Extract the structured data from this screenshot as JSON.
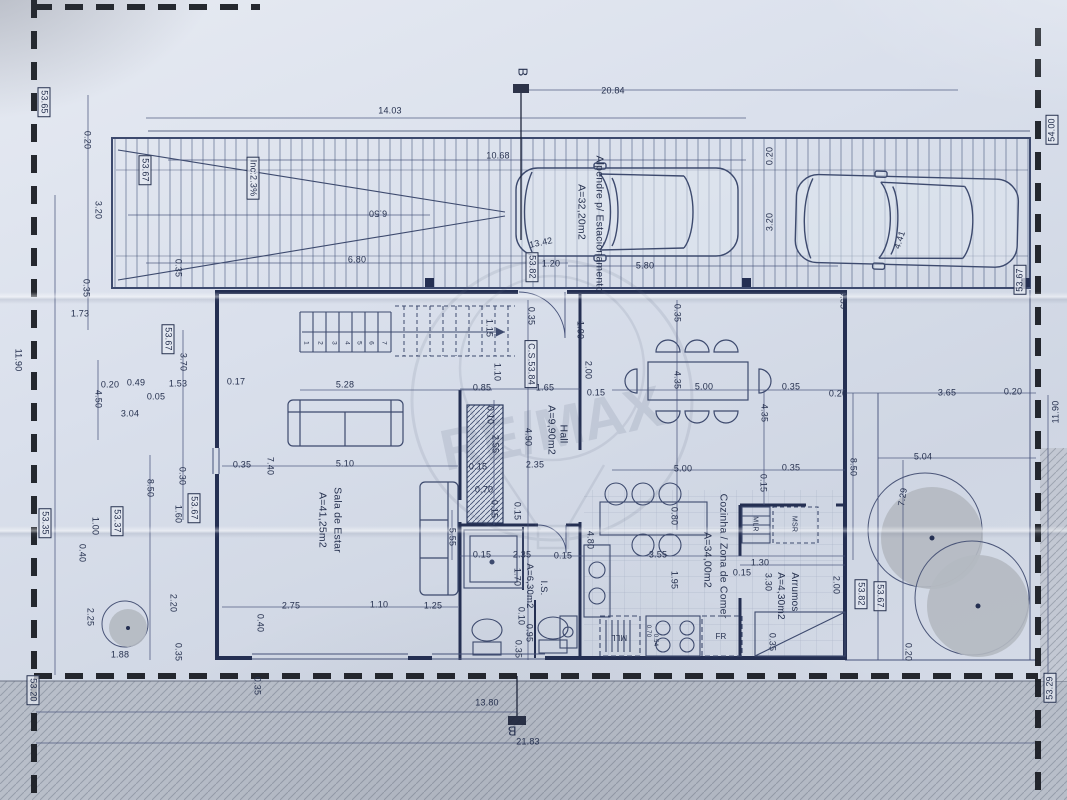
{
  "watermark": {
    "text": "RE/MAX"
  },
  "colors": {
    "paper": "#d7dde8",
    "ink": "#2c3a5e",
    "walls": "#242f52",
    "boundary": "#15181e",
    "road": "#b8bec9",
    "tree": "#b4b9c1"
  },
  "section_markers": {
    "top": "B",
    "bottom": "B"
  },
  "rooms": [
    {
      "name": "Sala de Estar",
      "area": "A=41,25m2"
    },
    {
      "name": "Hall",
      "area": "A=9,90m2"
    },
    {
      "name": "Cozinha / Zona de Comer",
      "area": "A=34,00m2"
    },
    {
      "name": "I.S.",
      "area": "A=6,30m2"
    },
    {
      "name": "Arrumos",
      "area": "A=4,30m2"
    },
    {
      "name": "Alpendre p/ Estacionamento",
      "area": "A=32,20m2"
    }
  ],
  "plan": {
    "labels": [
      {
        "n": "section-marker-top",
        "t": "B",
        "x": 523,
        "y": 72,
        "r": 90,
        "fs": 13
      },
      {
        "t": "20.84",
        "x": 613,
        "y": 91
      },
      {
        "t": "14.03",
        "x": 390,
        "y": 111
      },
      {
        "t": "10.68",
        "x": 498,
        "y": 156
      },
      {
        "n": "ramp-slope-label",
        "t": "Inc:2.3%",
        "x": 253,
        "y": 178,
        "r": 90,
        "box": 1
      },
      {
        "n": "elevation-label",
        "t": "53.67",
        "x": 145,
        "y": 170,
        "r": 90,
        "box": 1
      },
      {
        "n": "elevation-label",
        "t": "53.65",
        "x": 44,
        "y": 102,
        "r": 90,
        "box": 1
      },
      {
        "t": "0.20",
        "x": 87,
        "y": 140,
        "r": 90
      },
      {
        "t": "3.20",
        "x": 98,
        "y": 210,
        "r": 90
      },
      {
        "t": "0.35",
        "x": 86,
        "y": 288,
        "r": 90
      },
      {
        "t": "1.73",
        "x": 80,
        "y": 314
      },
      {
        "t": "6.50",
        "x": 378,
        "y": 213,
        "r": 180
      },
      {
        "t": "6.80",
        "x": 357,
        "y": 260
      },
      {
        "t": "0.35",
        "x": 178,
        "y": 268,
        "r": 90
      },
      {
        "t": "13.42",
        "x": 541,
        "y": 243,
        "r": -12
      },
      {
        "n": "elevation-label",
        "t": "53.82",
        "x": 532,
        "y": 267,
        "r": 90,
        "box": 1
      },
      {
        "t": "1.20",
        "x": 551,
        "y": 264
      },
      {
        "t": "5.80",
        "x": 645,
        "y": 266
      },
      {
        "t": "0.20",
        "x": 770,
        "y": 156,
        "r": -90
      },
      {
        "t": "3.20",
        "x": 770,
        "y": 222,
        "r": -90
      },
      {
        "n": "room-label-alpendre",
        "t": "Alpendre p/ Estacionamento",
        "x": 599,
        "y": 224,
        "r": 90,
        "fs": 10.5
      },
      {
        "n": "room-area-alpendre",
        "t": "A=32,20m2",
        "x": 581,
        "y": 212,
        "r": 90,
        "fs": 10.5
      },
      {
        "t": "4.41",
        "x": 900,
        "y": 240,
        "r": -72
      },
      {
        "t": "0.35",
        "x": 843,
        "y": 300,
        "r": 90
      },
      {
        "n": "elevation-label",
        "t": "53.67",
        "x": 1020,
        "y": 280,
        "r": -90,
        "box": 1
      },
      {
        "n": "elevation-label",
        "t": "54.00",
        "x": 1052,
        "y": 130,
        "r": -90,
        "box": 1
      },
      {
        "t": "0.20",
        "x": 838,
        "y": 394
      },
      {
        "t": "3.65",
        "x": 947,
        "y": 393
      },
      {
        "t": "0.20",
        "x": 1013,
        "y": 392
      },
      {
        "t": "11.90",
        "x": 1056,
        "y": 412,
        "r": -90
      },
      {
        "t": "5.04",
        "x": 923,
        "y": 457
      },
      {
        "t": "7.29",
        "x": 903,
        "y": 497,
        "r": -80
      },
      {
        "t": "8.50",
        "x": 853,
        "y": 467,
        "r": 90
      },
      {
        "n": "elevation-label",
        "t": "53.82",
        "x": 861,
        "y": 594,
        "r": 90,
        "box": 1
      },
      {
        "n": "elevation-label",
        "t": "53.67",
        "x": 880,
        "y": 596,
        "r": 90,
        "box": 1
      },
      {
        "t": "0.20",
        "x": 908,
        "y": 652,
        "r": 90
      },
      {
        "t": "2.00",
        "x": 836,
        "y": 585,
        "r": 90
      },
      {
        "n": "elevation-label",
        "t": "53.29",
        "x": 1050,
        "y": 688,
        "r": -90,
        "box": 1
      },
      {
        "t": "11.90",
        "x": 18,
        "y": 360,
        "r": 90
      },
      {
        "n": "elevation-label",
        "t": "53.35",
        "x": 45,
        "y": 523,
        "r": 90,
        "box": 1
      },
      {
        "n": "elevation-label",
        "t": "53.37",
        "x": 117,
        "y": 521,
        "r": 90,
        "box": 1
      },
      {
        "t": "1.00",
        "x": 95,
        "y": 526,
        "r": 90
      },
      {
        "n": "elevation-label",
        "t": "53.20",
        "x": 33,
        "y": 690,
        "r": 90,
        "box": 1
      },
      {
        "t": "0.40",
        "x": 82,
        "y": 553,
        "r": 90
      },
      {
        "t": "2.25",
        "x": 90,
        "y": 617,
        "r": 90
      },
      {
        "t": "1.88",
        "x": 120,
        "y": 655
      },
      {
        "t": "2.20",
        "x": 173,
        "y": 603,
        "r": 90
      },
      {
        "t": "0.35",
        "x": 178,
        "y": 652,
        "r": 90
      },
      {
        "t": "8.50",
        "x": 150,
        "y": 488,
        "r": 90
      },
      {
        "t": "0.30",
        "x": 182,
        "y": 476,
        "r": 90
      },
      {
        "t": "1.60",
        "x": 178,
        "y": 514,
        "r": 90
      },
      {
        "n": "elevation-label",
        "t": "53.67",
        "x": 194,
        "y": 508,
        "r": 90,
        "box": 1
      },
      {
        "t": "4.50",
        "x": 98,
        "y": 399,
        "r": 90
      },
      {
        "t": "0.20",
        "x": 110,
        "y": 385
      },
      {
        "t": "0.49",
        "x": 136,
        "y": 383
      },
      {
        "t": "0.05",
        "x": 156,
        "y": 397
      },
      {
        "t": "3.04",
        "x": 130,
        "y": 414
      },
      {
        "t": "1.53",
        "x": 178,
        "y": 384
      },
      {
        "t": "3.70",
        "x": 183,
        "y": 362,
        "r": 90
      },
      {
        "n": "elevation-label",
        "t": "53.67",
        "x": 168,
        "y": 339,
        "r": 90,
        "box": 1
      },
      {
        "t": "0.17",
        "x": 236,
        "y": 382
      },
      {
        "t": "0.35",
        "x": 242,
        "y": 465
      },
      {
        "t": "7.40",
        "x": 270,
        "y": 466,
        "r": 90
      },
      {
        "t": "5.28",
        "x": 345,
        "y": 385
      },
      {
        "t": "5.10",
        "x": 345,
        "y": 464
      },
      {
        "t": "0.85",
        "x": 482,
        "y": 388
      },
      {
        "t": "1.65",
        "x": 545,
        "y": 388
      },
      {
        "t": "0.15",
        "x": 596,
        "y": 393
      },
      {
        "t": "1.15",
        "x": 489,
        "y": 328,
        "r": 90
      },
      {
        "t": "1.10",
        "x": 497,
        "y": 372,
        "r": 90
      },
      {
        "t": "0.35",
        "x": 531,
        "y": 316,
        "r": 90
      },
      {
        "n": "elevation-label",
        "t": "C.S.53.84",
        "x": 531,
        "y": 364,
        "r": 90,
        "box": 1
      },
      {
        "t": "1.00",
        "x": 580,
        "y": 330,
        "r": 90
      },
      {
        "t": "2.00",
        "x": 588,
        "y": 370,
        "r": 90
      },
      {
        "t": "4.90",
        "x": 528,
        "y": 437,
        "r": 90
      },
      {
        "t": "2.35",
        "x": 535,
        "y": 465
      },
      {
        "t": "0.10",
        "x": 490,
        "y": 415,
        "r": 90
      },
      {
        "t": "2.55",
        "x": 495,
        "y": 444,
        "r": 90
      },
      {
        "t": "0.15",
        "x": 478,
        "y": 467
      },
      {
        "t": "0.70",
        "x": 484,
        "y": 490
      },
      {
        "t": "0.15",
        "x": 494,
        "y": 509,
        "r": 90
      },
      {
        "t": "0.15",
        "x": 517,
        "y": 511,
        "r": 90
      },
      {
        "t": "5.55",
        "x": 452,
        "y": 537,
        "r": 90
      },
      {
        "n": "room-label-sala",
        "t": "Sala de Estar",
        "x": 337,
        "y": 520,
        "r": 90,
        "fs": 10.5
      },
      {
        "n": "room-area-sala",
        "t": "A=41,25m2",
        "x": 322,
        "y": 520,
        "r": 90,
        "fs": 10.5
      },
      {
        "n": "room-label-hall",
        "t": "Hall",
        "x": 563,
        "y": 434,
        "r": 90,
        "fs": 10.5
      },
      {
        "n": "room-area-hall",
        "t": "A=9,90m2",
        "x": 551,
        "y": 430,
        "r": 90,
        "fs": 10.5
      },
      {
        "t": "0.35",
        "x": 677,
        "y": 313,
        "r": 90
      },
      {
        "t": "4.35",
        "x": 677,
        "y": 380,
        "r": 90
      },
      {
        "t": "5.00",
        "x": 704,
        "y": 387
      },
      {
        "t": "0.35",
        "x": 791,
        "y": 387
      },
      {
        "t": "4.35",
        "x": 764,
        "y": 413,
        "r": 90
      },
      {
        "t": "5.00",
        "x": 683,
        "y": 469
      },
      {
        "t": "0.35",
        "x": 791,
        "y": 468
      },
      {
        "t": "0.15",
        "x": 763,
        "y": 483,
        "r": 90
      },
      {
        "t": "0.80",
        "x": 674,
        "y": 516,
        "r": 90
      },
      {
        "n": "room-label-cozinha",
        "t": "Cozinha / Zona de Comer",
        "x": 723,
        "y": 556,
        "r": 90,
        "fs": 10.5
      },
      {
        "n": "room-area-cozinha",
        "t": "A=34,00m2",
        "x": 707,
        "y": 560,
        "r": 90,
        "fs": 10.5
      },
      {
        "t": "4.80",
        "x": 590,
        "y": 540,
        "r": 90
      },
      {
        "t": "3.55",
        "x": 658,
        "y": 555
      },
      {
        "t": "1.95",
        "x": 674,
        "y": 580,
        "r": 90
      },
      {
        "t": "1.30",
        "x": 760,
        "y": 563
      },
      {
        "t": "0.15",
        "x": 742,
        "y": 573
      },
      {
        "t": "3.30",
        "x": 768,
        "y": 582,
        "r": 90
      },
      {
        "n": "room-label-arrumos",
        "t": "Arrumos",
        "x": 794,
        "y": 592,
        "r": 90,
        "fs": 10
      },
      {
        "n": "room-area-arrumos",
        "t": "A=4,30m2",
        "x": 780,
        "y": 596,
        "r": 90,
        "fs": 10
      },
      {
        "n": "closet-label",
        "t": "MLR",
        "x": 755,
        "y": 524,
        "r": 90,
        "fs": 7
      },
      {
        "n": "closet-label",
        "t": "MSR",
        "x": 794,
        "y": 524,
        "r": 90,
        "fs": 7
      },
      {
        "t": "0.35",
        "x": 772,
        "y": 642,
        "r": 90
      },
      {
        "n": "appliance-label-dishwasher",
        "t": "MLL",
        "x": 619,
        "y": 637,
        "r": 180,
        "fs": 8
      },
      {
        "n": "appliance-label-fridge",
        "t": "FR",
        "x": 721,
        "y": 637,
        "fs": 8
      },
      {
        "t": "0.70",
        "x": 648,
        "y": 631,
        "r": 90,
        "fs": 6
      },
      {
        "t": "0.54",
        "x": 655,
        "y": 640,
        "r": 90,
        "fs": 6
      },
      {
        "t": "0.15",
        "x": 482,
        "y": 555
      },
      {
        "t": "2.35",
        "x": 522,
        "y": 555
      },
      {
        "t": "0.15",
        "x": 563,
        "y": 556
      },
      {
        "n": "room-label-is",
        "t": "I.S.",
        "x": 543,
        "y": 588,
        "r": 90,
        "fs": 9.5
      },
      {
        "n": "room-area-is",
        "t": "A=6,30m2",
        "x": 529,
        "y": 586,
        "r": 90,
        "fs": 9.5
      },
      {
        "t": "1.70",
        "x": 517,
        "y": 577,
        "r": 90
      },
      {
        "t": "0.10",
        "x": 521,
        "y": 616,
        "r": 90
      },
      {
        "t": "0.95",
        "x": 529,
        "y": 633,
        "r": 90
      },
      {
        "t": "0.35",
        "x": 518,
        "y": 649,
        "r": 90
      },
      {
        "t": "0.35",
        "x": 257,
        "y": 686,
        "r": 90
      },
      {
        "t": "2.75",
        "x": 291,
        "y": 606
      },
      {
        "t": "1.10",
        "x": 379,
        "y": 605
      },
      {
        "t": "1.25",
        "x": 433,
        "y": 606
      },
      {
        "t": "0.40",
        "x": 260,
        "y": 623,
        "r": 90
      },
      {
        "t": "13.80",
        "x": 487,
        "y": 703
      },
      {
        "n": "section-marker-bottom",
        "t": "B",
        "x": 512,
        "y": 731,
        "r": 180,
        "fs": 13
      },
      {
        "t": "21.83",
        "x": 528,
        "y": 742
      },
      {
        "n": "stair-step-number",
        "t": "1",
        "x": 305,
        "y": 343,
        "r": 90,
        "fs": 6.5
      },
      {
        "n": "stair-step-number",
        "t": "2",
        "x": 319,
        "y": 343,
        "r": 90,
        "fs": 6.5
      },
      {
        "n": "stair-step-number",
        "t": "3",
        "x": 333,
        "y": 343,
        "r": 90,
        "fs": 6.5
      },
      {
        "n": "stair-step-number",
        "t": "4",
        "x": 346,
        "y": 343,
        "r": 90,
        "fs": 6.5
      },
      {
        "n": "stair-step-number",
        "t": "5",
        "x": 358,
        "y": 343,
        "r": 90,
        "fs": 6.5
      },
      {
        "n": "stair-step-number",
        "t": "6",
        "x": 370,
        "y": 343,
        "r": 90,
        "fs": 6.5
      },
      {
        "n": "stair-step-number",
        "t": "7",
        "x": 383,
        "y": 343,
        "r": 90,
        "fs": 6.5
      }
    ]
  }
}
